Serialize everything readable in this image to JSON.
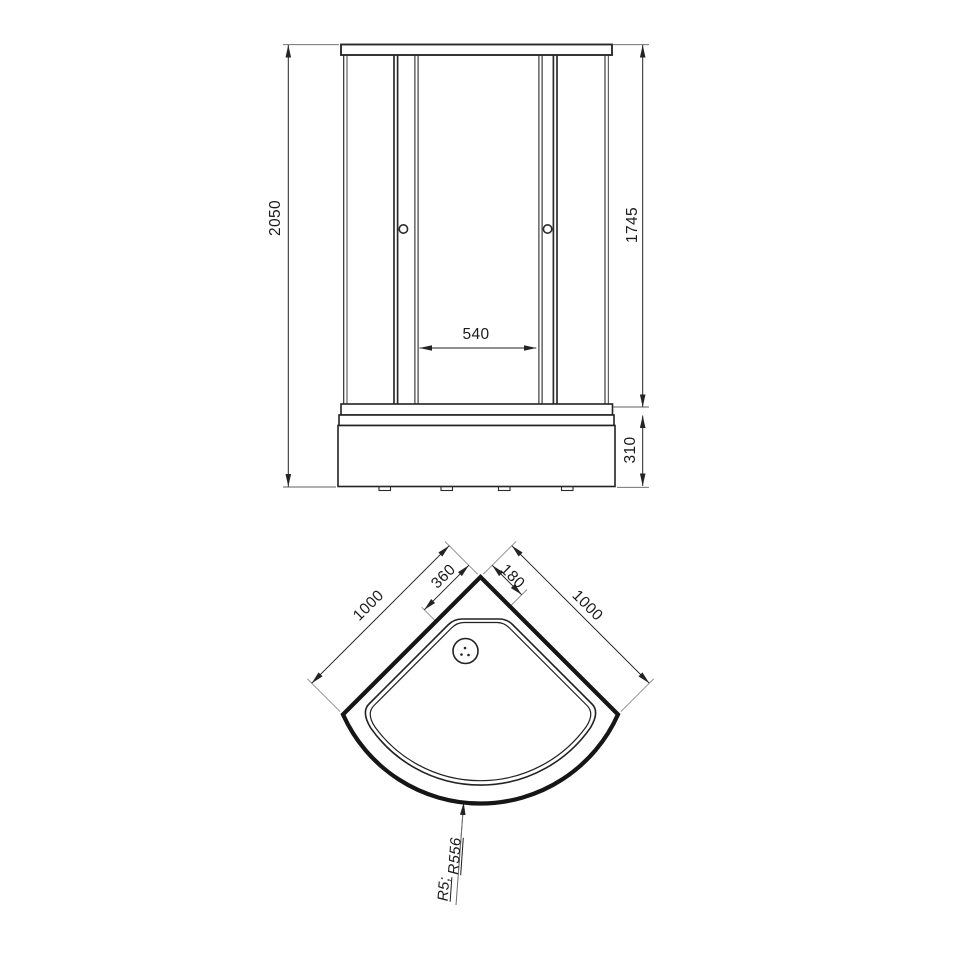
{
  "front_view": {
    "dim_total_height": "2050",
    "dim_glass_height": "1745",
    "dim_door_opening": "540",
    "dim_tray_height": "310"
  },
  "top_view": {
    "dim_side_left": "1000",
    "dim_side_right": "1000",
    "dim_drain_from_corner_left": "360",
    "dim_drain_from_corner_right": "180",
    "radius_small": "R5;",
    "radius_front": "R556"
  }
}
